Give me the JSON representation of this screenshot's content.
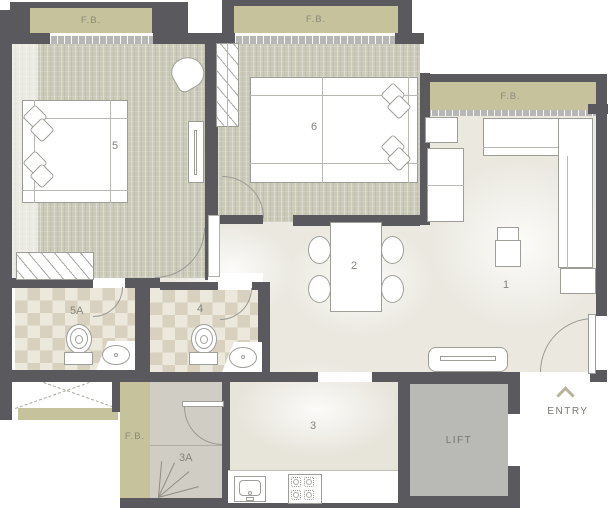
{
  "plan": {
    "unit_labels": {
      "living": "1",
      "dining": "2",
      "kitchen": "3",
      "utility": "3A",
      "common_bath": "4",
      "bedroom_left": "5",
      "attached_bath": "5A",
      "bedroom_middle": "6",
      "lift": "LIFT",
      "entry": "ENTRY"
    },
    "balcony_labels": {
      "top_left": "F.B.",
      "top_middle": "F.B.",
      "right": "F.B.",
      "bottom_left": "F.B."
    },
    "colors": {
      "wall": "#5a595d",
      "flower_bed": "#c6c39c",
      "bedroom_floor": "#cbcab9",
      "main_floor": "#eae8df",
      "bath_tile_dark": "#d8d1c0",
      "bath_tile_light": "#ece8dc",
      "utility_floor": "#d0cdc4",
      "lift_floor": "#b9b9b5",
      "label_text": "#85857b"
    }
  }
}
